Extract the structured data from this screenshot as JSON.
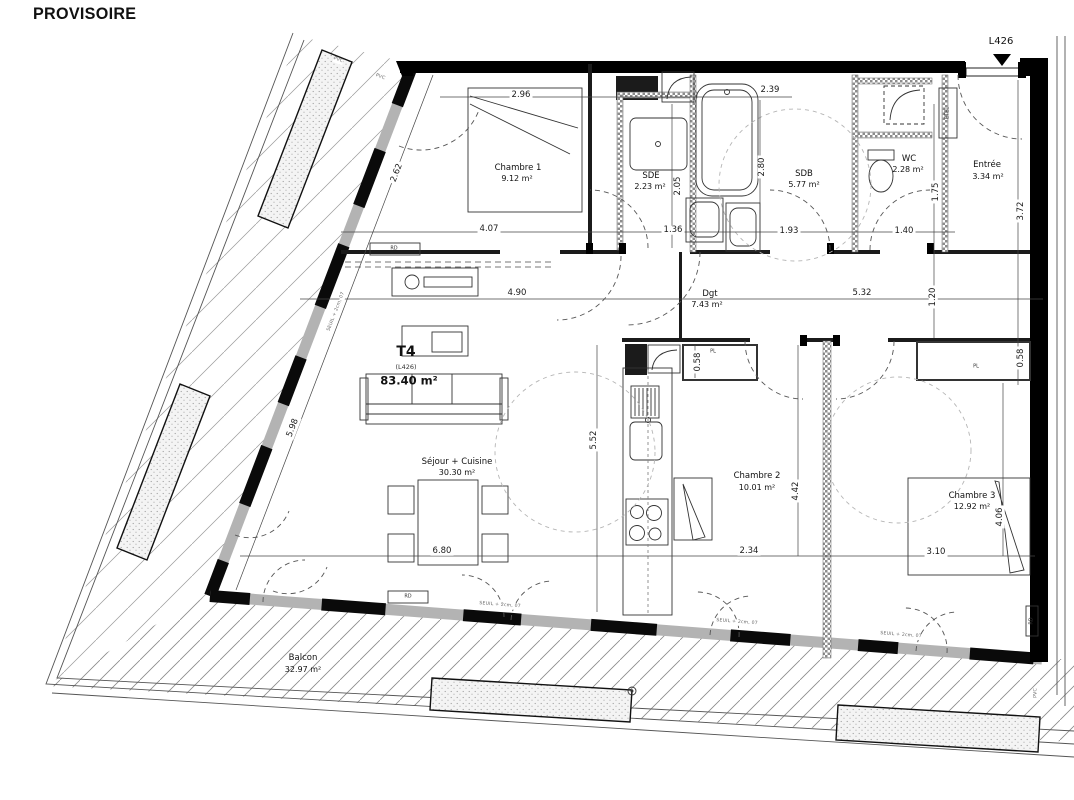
{
  "title": "PROVISOIRE",
  "unit": {
    "label": "L426",
    "type": "T4",
    "ref": "(L426)",
    "area": "83.40 m²"
  },
  "rooms": [
    {
      "name": "Chambre 1",
      "area": "9.12 m²"
    },
    {
      "name": "SDE",
      "area": "2.23 m²"
    },
    {
      "name": "SDB",
      "area": "5.77 m²"
    },
    {
      "name": "WC",
      "area": "2.28 m²"
    },
    {
      "name": "Entrée",
      "area": "3.34 m²"
    },
    {
      "name": "Dgt",
      "area": "7.43 m²"
    },
    {
      "name": "Séjour + Cuisine",
      "area": "30.30 m²"
    },
    {
      "name": "Chambre 2",
      "area": "10.01 m²"
    },
    {
      "name": "Chambre 3",
      "area": "12.92 m²"
    },
    {
      "name": "Balcon",
      "area": "32.97 m²"
    }
  ],
  "dims": {
    "chambre1_top": "2.96",
    "chambre1_bottom": "4.07",
    "sde_height": "2.05",
    "sde_width": "1.36",
    "sdb_top": "2.39",
    "sdb_height": "2.80",
    "sdb_bottom": "1.93",
    "wc_bottom": "1.40",
    "wc_height": "1.75",
    "entree_height": "3.72",
    "sejour_top": "4.90",
    "dgt_width": "5.32",
    "dgt_height": "1.20",
    "placard_right": "0.58",
    "placard_mid": "0.58",
    "kitchen_height": "5.52",
    "sejour_width": "6.80",
    "chambre2_width": "2.34",
    "chambre2_height": "4.42",
    "chambre3_width": "3.10",
    "chambre3_height": "4.06",
    "wall_upper": "2.62",
    "wall_lower": "5.98"
  },
  "annotations": {
    "seuil": "SEUIL + 2cm, 07",
    "radiator": "RD",
    "window_material": "PVC",
    "electrical": "ETEL",
    "closet": "PL"
  },
  "colors": {
    "line": "#1a1a1a",
    "wall": "#000000",
    "hatch": "#8a8a8a",
    "dim_text": "#1a1a1a",
    "annotation_text": "#666666"
  }
}
